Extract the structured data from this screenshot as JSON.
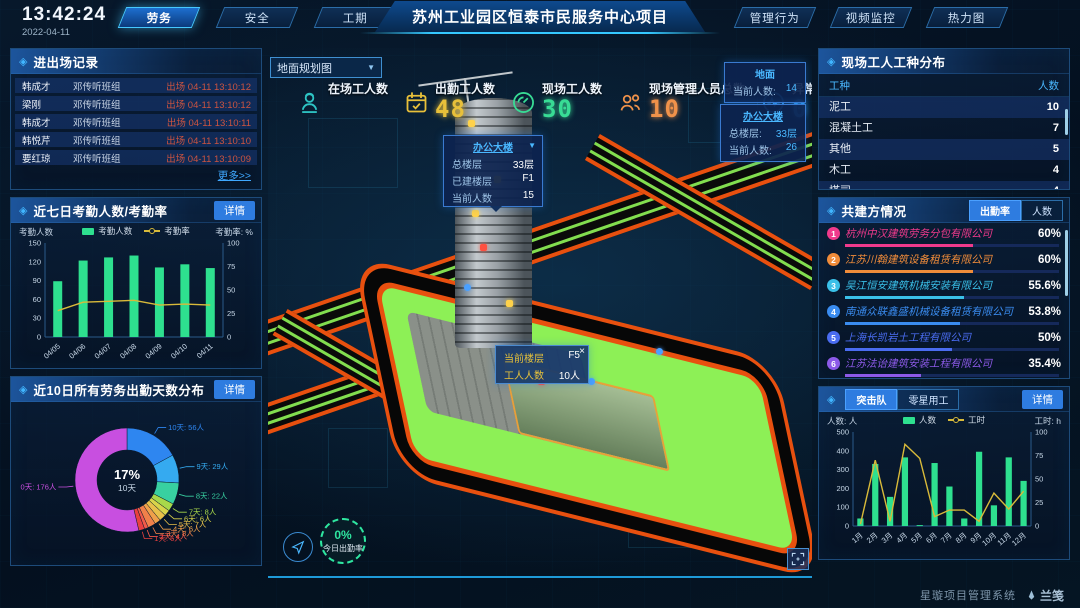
{
  "header": {
    "time": "13:42:24",
    "date": "2022-04-11",
    "left_tabs": [
      {
        "label": "劳务",
        "active": true
      },
      {
        "label": "安全",
        "active": false
      },
      {
        "label": "工期",
        "active": false
      }
    ],
    "title": "苏州工业园区恒泰市民服务中心项目",
    "right_tabs": [
      {
        "label": "管理行为",
        "active": false
      },
      {
        "label": "视频监控",
        "active": false
      },
      {
        "label": "热力图",
        "active": false
      }
    ]
  },
  "left": {
    "records": {
      "title": "进出场记录",
      "rows": [
        {
          "name": "韩成才",
          "team": "邓传听班组",
          "event": "出场 04-11 13:10:12"
        },
        {
          "name": "梁刚",
          "team": "邓传听班组",
          "event": "出场 04-11 13:10:12"
        },
        {
          "name": "韩成才",
          "team": "邓传听班组",
          "event": "出场 04-11 13:10:11"
        },
        {
          "name": "韩悦芹",
          "team": "邓传听班组",
          "event": "出场 04-11 13:10:10"
        },
        {
          "name": "要红琼",
          "team": "邓传听班组",
          "event": "出场 04-11 13:10:09"
        }
      ],
      "more": "更多>>"
    },
    "attendance": {
      "title": "近七日考勤人数/考勤率",
      "detail": "详情"
    },
    "distribution": {
      "title": "近10日所有劳务出勤天数分布",
      "detail": "详情"
    }
  },
  "center": {
    "view_select": "地面规划图",
    "stats": [
      {
        "label": "在场工人数",
        "value": "",
        "icon": "worker-icon",
        "color": "#2ec5c5"
      },
      {
        "label": "出勤工人数",
        "value": "48",
        "icon": "calendar-check-icon",
        "color": "#e8c03a"
      },
      {
        "label": "现场工人数",
        "value": "30",
        "icon": "gauge-icon",
        "color": "#38dc95"
      },
      {
        "label": "现场管理人员总数",
        "value": "10",
        "icon": "people-icon",
        "color": "#f0924a"
      },
      {
        "label": "异常出勤数",
        "value": "0",
        "icon": "pulse-icon",
        "color": "#2e9df0"
      }
    ],
    "building_popup": {
      "title": "办公大楼",
      "rows": [
        {
          "k": "总楼层",
          "v": "33层"
        },
        {
          "k": "已建楼层",
          "v": "F1"
        },
        {
          "k": "当前人数",
          "v": "15"
        }
      ]
    },
    "floor_popup": {
      "close": "×",
      "rows": [
        {
          "k": "当前楼层",
          "v": "F5"
        },
        {
          "k": "工人人数",
          "v": "10人"
        }
      ]
    },
    "side_popups": [
      {
        "title": "地面",
        "rows": [
          {
            "k": "当前人数:",
            "v": "14"
          }
        ]
      },
      {
        "title": "办公大楼",
        "rows": [
          {
            "k": "总楼层:",
            "v": "33层"
          },
          {
            "k": "当前人数:",
            "v": "26"
          }
        ]
      }
    ],
    "gauge": {
      "value": "0%",
      "label": "今日出勤率"
    }
  },
  "right": {
    "trades": {
      "title": "现场工人工种分布",
      "headers": [
        "工种",
        "人数"
      ],
      "rows": [
        [
          "泥工",
          "10"
        ],
        [
          "混凝土工",
          "7"
        ],
        [
          "其他",
          "5"
        ],
        [
          "木工",
          "4"
        ],
        [
          "塔司",
          "4"
        ]
      ]
    },
    "partners": {
      "title": "共建方情况",
      "tabs": [
        {
          "label": "出勤率",
          "active": true
        },
        {
          "label": "人数",
          "active": false
        }
      ],
      "companies": [
        {
          "rank": "1",
          "name": "杭州中汉建筑劳务分包有限公司",
          "value": "60%",
          "pct": 60,
          "color": "#f03a8c"
        },
        {
          "rank": "2",
          "name": "江苏川翰建筑设备租赁有限公司",
          "value": "60%",
          "pct": 60,
          "color": "#f08c3a"
        },
        {
          "rank": "3",
          "name": "吴江恒安建筑机械安装有限公司",
          "value": "55.6%",
          "pct": 55.6,
          "color": "#3ac0e8"
        },
        {
          "rank": "4",
          "name": "南通众联鑫盛机械设备租赁有限公司",
          "value": "53.8%",
          "pct": 53.8,
          "color": "#3a8cf0"
        },
        {
          "rank": "5",
          "name": "上海长凯岩土工程有限公司",
          "value": "50%",
          "pct": 50,
          "color": "#4a6cf0"
        },
        {
          "rank": "6",
          "name": "江苏法诒建筑安装工程有限公司",
          "value": "35.4%",
          "pct": 35.4,
          "color": "#8c5ae8"
        }
      ]
    },
    "squad": {
      "tabs": [
        {
          "label": "突击队",
          "active": true
        },
        {
          "label": "零星用工",
          "active": false
        }
      ],
      "detail": "详情"
    }
  },
  "footer": {
    "system": "星璇项目管理系统",
    "brand": "兰笺"
  },
  "chart_data": [
    {
      "type": "bar+line",
      "title": "近七日考勤人数/考勤率",
      "categories": [
        "04/05",
        "04/06",
        "04/07",
        "04/08",
        "04/09",
        "04/10",
        "04/11"
      ],
      "series": [
        {
          "name": "考勤人数",
          "type": "bar",
          "axis": "left",
          "color": "#2ee08f",
          "values": [
            89,
            122,
            127,
            130,
            111,
            116,
            110
          ]
        },
        {
          "name": "考勤率",
          "type": "line",
          "axis": "right",
          "color": "#d8ba3a",
          "values": [
            28,
            37,
            38,
            39,
            34,
            35,
            34
          ]
        }
      ],
      "left_axis": {
        "label": "考勤人数",
        "min": 0,
        "max": 150,
        "ticks": [
          0,
          30,
          60,
          90,
          120,
          150
        ]
      },
      "right_axis": {
        "label": "考勤率: %",
        "min": 0,
        "max": 100,
        "ticks": [
          0,
          25,
          50,
          75,
          100
        ]
      },
      "legend_position": "top",
      "grid": false
    },
    {
      "type": "pie",
      "title": "近10日所有劳务出勤天数分布",
      "slices": [
        {
          "label": "10天",
          "people": "56人",
          "value": 56,
          "color": "#2e86f0"
        },
        {
          "label": "9天",
          "people": "29人",
          "value": 29,
          "color": "#35aaf0"
        },
        {
          "label": "8天",
          "people": "22人",
          "value": 22,
          "color": "#38d0a0"
        },
        {
          "label": "7天",
          "people": "8人",
          "value": 8,
          "color": "#a8d84a"
        },
        {
          "label": "6天",
          "people": "6人",
          "value": 6,
          "color": "#d8d44a"
        },
        {
          "label": "5天",
          "people": "7人",
          "value": 7,
          "color": "#e8c04a"
        },
        {
          "label": "4天",
          "people": "6人",
          "value": 6,
          "color": "#f0a04a"
        },
        {
          "label": "3天",
          "people": "8人",
          "value": 8,
          "color": "#f0804a"
        },
        {
          "label": "2天",
          "people": "4人",
          "value": 4,
          "color": "#f05a4a"
        },
        {
          "label": "1天",
          "people": "6人",
          "value": 6,
          "color": "#e84040"
        },
        {
          "label": "0天",
          "people": "176人",
          "value": 176,
          "color": "#c84fe0"
        }
      ],
      "center": {
        "pct": "17%",
        "label": "10天"
      }
    },
    {
      "type": "bar+line",
      "title": "突击队",
      "categories": [
        "1月",
        "2月",
        "3月",
        "4月",
        "5月",
        "6月",
        "7月",
        "8月",
        "9月",
        "10月",
        "11月",
        "12月"
      ],
      "series": [
        {
          "name": "人数",
          "type": "bar",
          "axis": "left",
          "color": "#2ee08f",
          "values": [
            40,
            330,
            155,
            365,
            5,
            335,
            210,
            40,
            395,
            110,
            365,
            240
          ]
        },
        {
          "name": "工时",
          "type": "line",
          "axis": "right",
          "color": "#d8ba3a",
          "values": [
            2,
            70,
            5,
            87,
            72,
            10,
            17,
            17,
            5,
            35,
            18,
            37
          ]
        }
      ],
      "left_axis": {
        "label": "人数: 人",
        "min": 0,
        "max": 500,
        "ticks": [
          0,
          100,
          200,
          300,
          400,
          500
        ]
      },
      "right_axis": {
        "label": "工时: h",
        "min": 0,
        "max": 100,
        "ticks": [
          0,
          25,
          50,
          75,
          100
        ]
      },
      "legend_position": "top",
      "grid": false
    }
  ]
}
